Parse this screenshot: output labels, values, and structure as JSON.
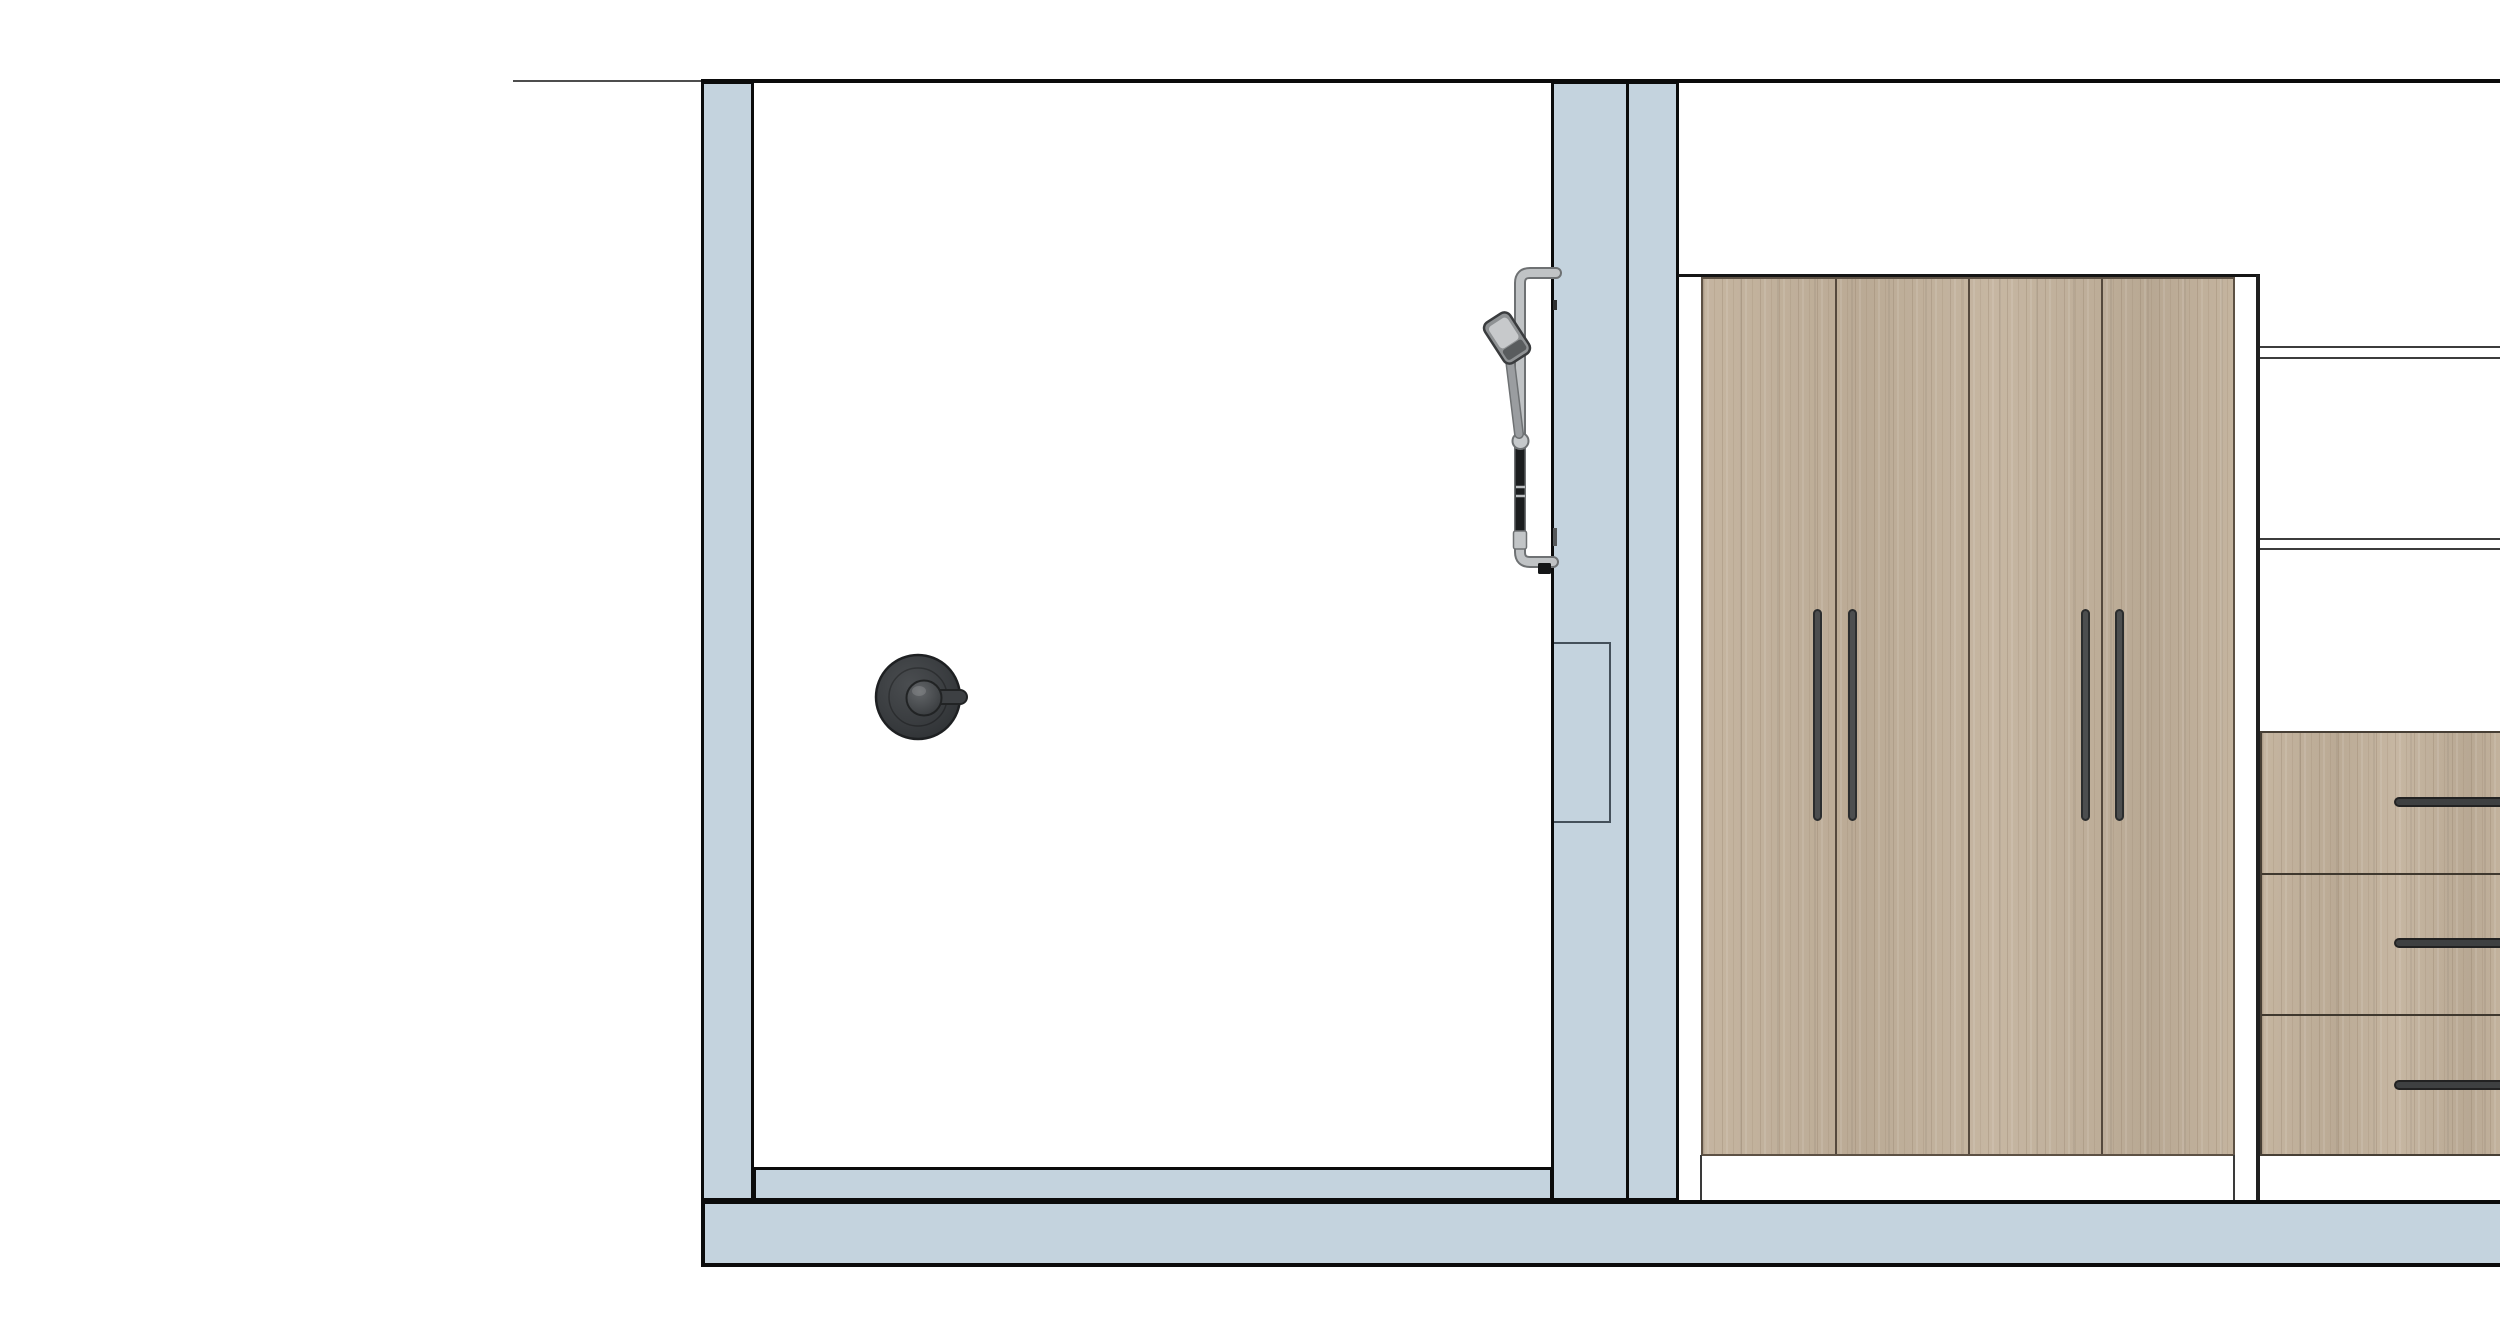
{
  "title": "Interior elevation drawing - shower room and wardrobe wall",
  "colors": {
    "background": "#ffffff",
    "wall_fill": "#c4d3de",
    "outline": "#0b0b0b",
    "wood_base": "#c2b19b",
    "handle_dark": "#4c4e4f",
    "fixture_gray": "#c0c3c5",
    "fixture_dark": "#1b1d1e",
    "mixer_body": "#393c3f"
  },
  "scene": {
    "left_room": {
      "role": "shower room elevation",
      "fixtures": [
        "shower-mixer-valve",
        "hand-shower-on-rail"
      ],
      "raised_floor_band": true
    },
    "divider_wall": {
      "layers": 2,
      "recessed_panel": true
    },
    "right_room": {
      "role": "wardrobe elevation",
      "wardrobe_door_count": 4,
      "door_handle_pairs": 2,
      "open_shelf_count": 2,
      "drawer_count": 3,
      "drawer_handle_count": 3
    },
    "floor_slab": true,
    "ceiling_line": true
  }
}
